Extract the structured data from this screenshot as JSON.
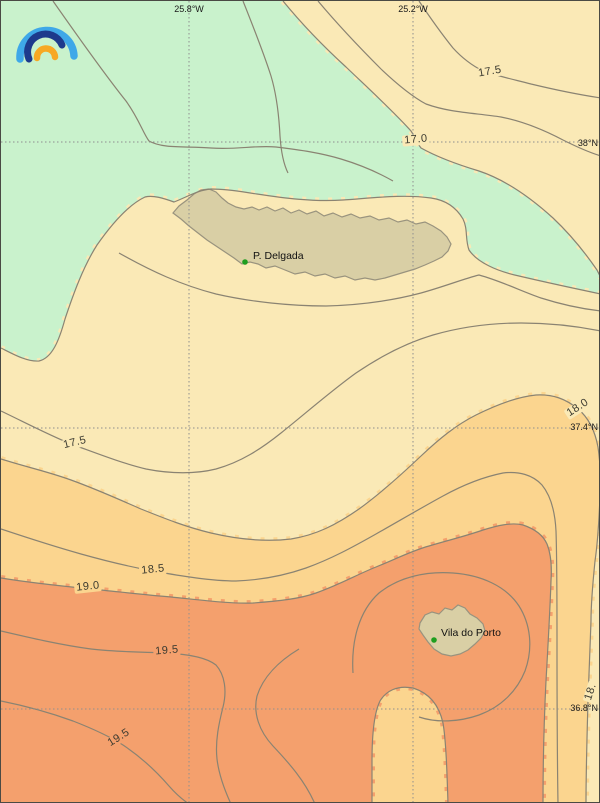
{
  "map": {
    "axis_labels": {
      "top": [
        {
          "text": "25.8°W"
        },
        {
          "text": "25.2°W"
        }
      ],
      "right": [
        {
          "text": "38°N"
        },
        {
          "text": "37.4°N"
        },
        {
          "text": "36.8°N"
        }
      ]
    },
    "contour_labels": [
      {
        "value": "17.5"
      },
      {
        "value": "17.0"
      },
      {
        "value": "17.5"
      },
      {
        "value": "18.0"
      },
      {
        "value": "18.5"
      },
      {
        "value": "19.0"
      },
      {
        "value": "19.5"
      },
      {
        "value": "19.5"
      },
      {
        "value": "18."
      }
    ],
    "cities": [
      {
        "name": "P. Delgada"
      },
      {
        "name": "Vila do Porto"
      }
    ],
    "colors": {
      "band_below_17": "#c9f2cc",
      "band_17_18": "#fae9b6",
      "band_18_19": "#fbd58f",
      "band_above_19": "#f4a06d",
      "land": "#d9cfa5",
      "land_border": "#99937e",
      "contour_line": "#8a8372",
      "grid_line": "#8f8f8f",
      "city_dot": "#1f9e1f",
      "logo_outer": "#3fa8e8",
      "logo_middle": "#1d3a8c",
      "logo_inner": "#f7a823"
    }
  }
}
